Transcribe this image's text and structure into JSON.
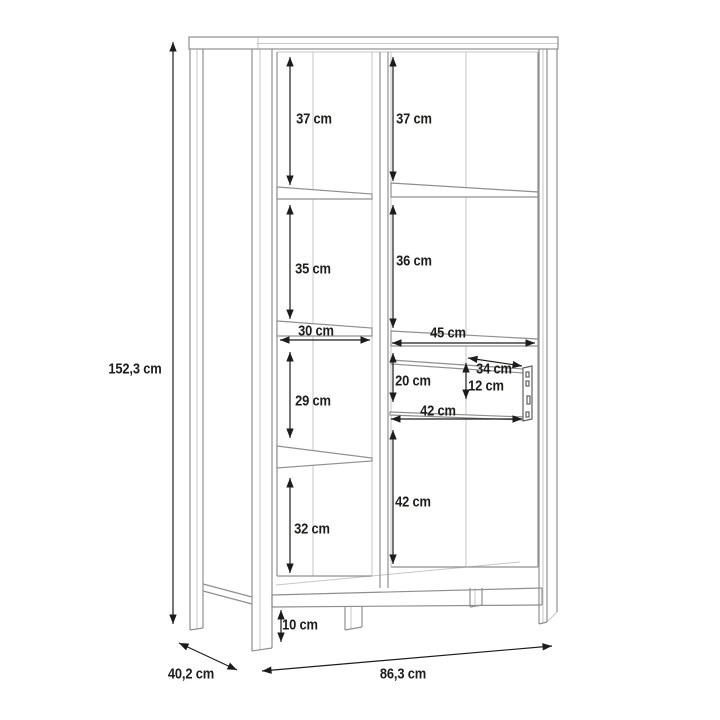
{
  "page": {
    "background": "#ffffff"
  },
  "diagram": {
    "type": "furniture-dimension-drawing",
    "subject": "display cabinet with two columns of shelves, a drawer and legs",
    "unit": "cm",
    "colors": {
      "structure_line": "#8f8f8f",
      "structure_line_light": "#c6c6c6",
      "dimension_line": "#1c1c1c",
      "label_text": "#1d1d1b",
      "background": "#ffffff"
    },
    "dimensions": {
      "overall_height": "152,3 cm",
      "overall_width": "86,3 cm",
      "overall_depth": "40,2 cm",
      "left_top_section": "37 cm",
      "right_top_section": "37 cm",
      "left_second_section": "35 cm",
      "right_second_section": "36 cm",
      "left_shelf_width": "30 cm",
      "right_shelf_width": "45 cm",
      "left_third_section": "29 cm",
      "drawer_gap_height": "20 cm",
      "drawer_depth": "34 cm",
      "drawer_height": "12 cm",
      "drawer_width": "42 cm",
      "left_bottom_section": "32 cm",
      "right_bottom_section": "42 cm",
      "leg_height": "10 cm"
    }
  }
}
